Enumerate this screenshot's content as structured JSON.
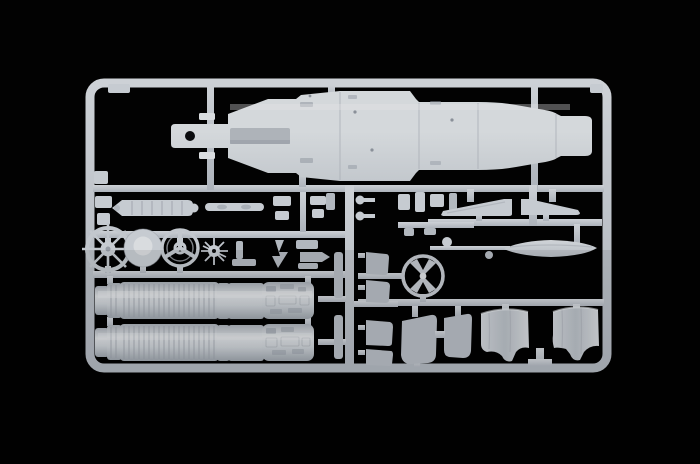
{
  "scene": {
    "alt": "Product photograph of a light grey injection-moulded plastic model kit sprue with jet aircraft parts on a black background",
    "colors": {
      "background": "#020202",
      "plastic_bright": "#d9dcdf",
      "plastic_mid": "#c6cbd1",
      "plastic_dim": "#b2b8bf",
      "plastic_shadow": "#969ca5",
      "hole_dark": "#0b0c0e"
    },
    "parts": [
      {
        "name": "fuselage-half",
        "label": "Fuselage half with nose boom",
        "qty": 1
      },
      {
        "name": "engine-afterburner-barrel",
        "label": "Ribbed engine / afterburner barrel",
        "qty": 2
      },
      {
        "name": "intake-cowl",
        "label": "Curved air intake cowl",
        "qty": 2
      },
      {
        "name": "landing-gear-door",
        "label": "Landing gear door panel",
        "qty": 2
      },
      {
        "name": "tail-fin-half",
        "label": "Tail fin half",
        "qty": 2
      },
      {
        "name": "drop-tank-half",
        "label": "External fuel tank half",
        "qty": 1
      },
      {
        "name": "wheel-spoked",
        "label": "Eight-spoke wheel",
        "qty": 1
      },
      {
        "name": "wheel-disc",
        "label": "Disc wheel with domed hub",
        "qty": 1
      },
      {
        "name": "wheel-three-spoke",
        "label": "Three-spoke wheel",
        "qty": 1
      },
      {
        "name": "hub-spider",
        "label": "Spider hub with radial spokes",
        "qty": 1
      },
      {
        "name": "ring-cross-hub",
        "label": "Ring wheel with X-shaped hub",
        "qty": 1
      },
      {
        "name": "boarding-ladder",
        "label": "Segmented ladder / rail part",
        "qty": 1
      },
      {
        "name": "antenna-rod",
        "label": "Thin rod part",
        "qty": 1
      },
      {
        "name": "small-detail-parts",
        "label": "Assorted small detail parts on runners",
        "qty": "many"
      }
    ]
  }
}
